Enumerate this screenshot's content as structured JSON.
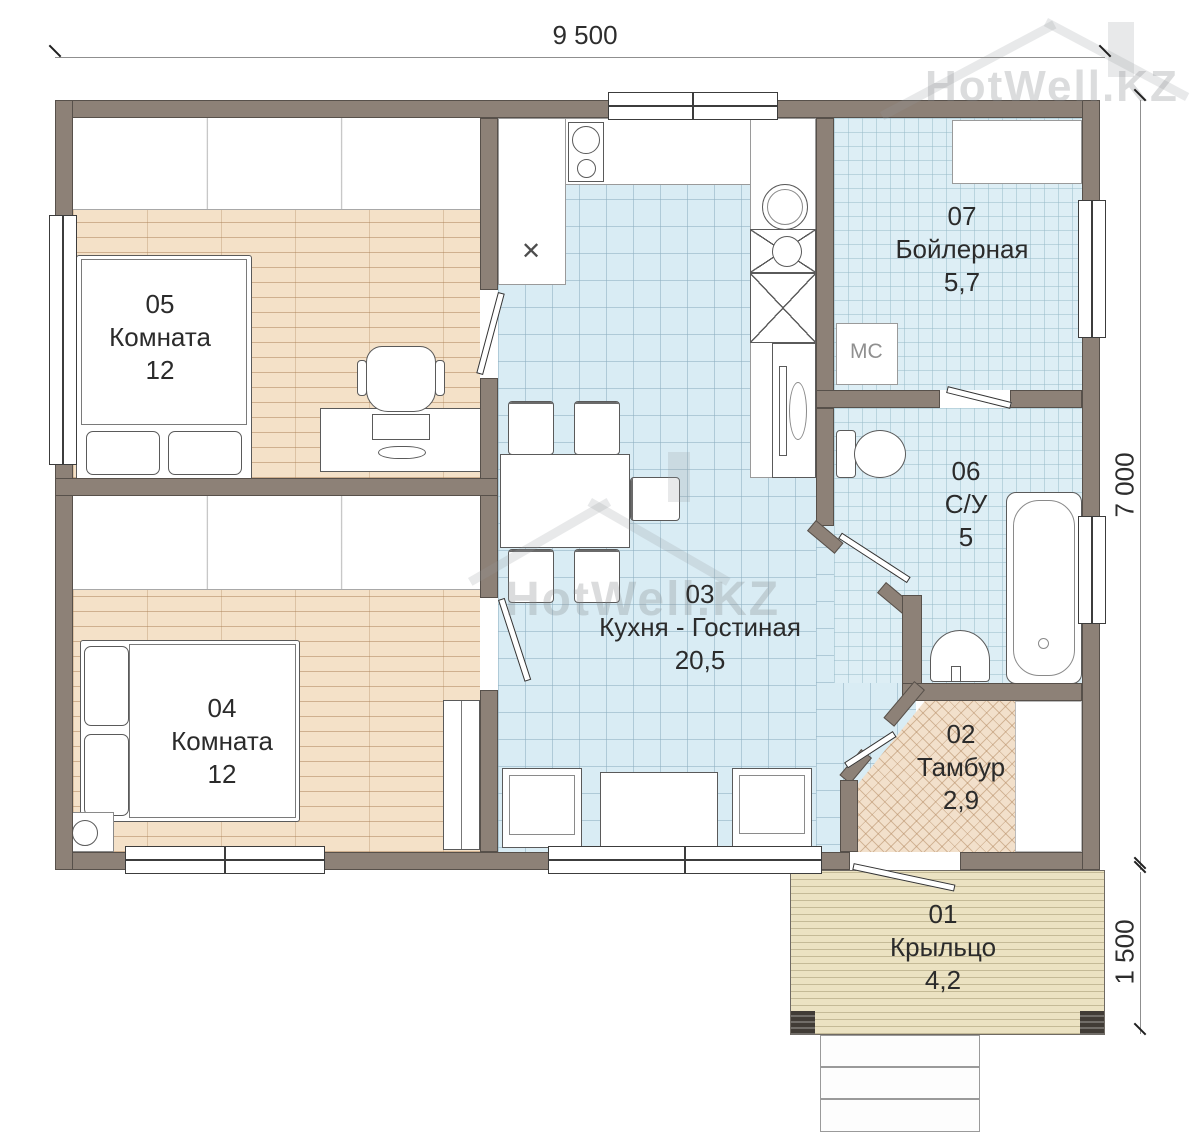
{
  "brand": {
    "watermark": "HotWell.KZ"
  },
  "dimensions": {
    "top_width_mm": "9 500",
    "right_height_mm": "7 000",
    "porch_height_mm": "1 500"
  },
  "rooms": {
    "r01": {
      "number": "01",
      "name": "Крыльцо",
      "area": "4,2"
    },
    "r02": {
      "number": "02",
      "name": "Тамбур",
      "area": "2,9"
    },
    "r03": {
      "number": "03",
      "name": "Кухня - Гостиная",
      "area": "20,5"
    },
    "r04": {
      "number": "04",
      "name": "Комната",
      "area": "12"
    },
    "r05": {
      "number": "05",
      "name": "Комната",
      "area": "12"
    },
    "r06": {
      "number": "06",
      "name": "С/У",
      "area": "5"
    },
    "r07": {
      "number": "07",
      "name": "Бойлерная",
      "area": "5,7"
    }
  },
  "labels": {
    "washing_machine": "МС",
    "sink_cross": "✕"
  },
  "colors": {
    "wall": "#8d8177",
    "tile": "#d9ecf4",
    "wood": "#f4e1c8",
    "porch": "#ebe2c2"
  }
}
